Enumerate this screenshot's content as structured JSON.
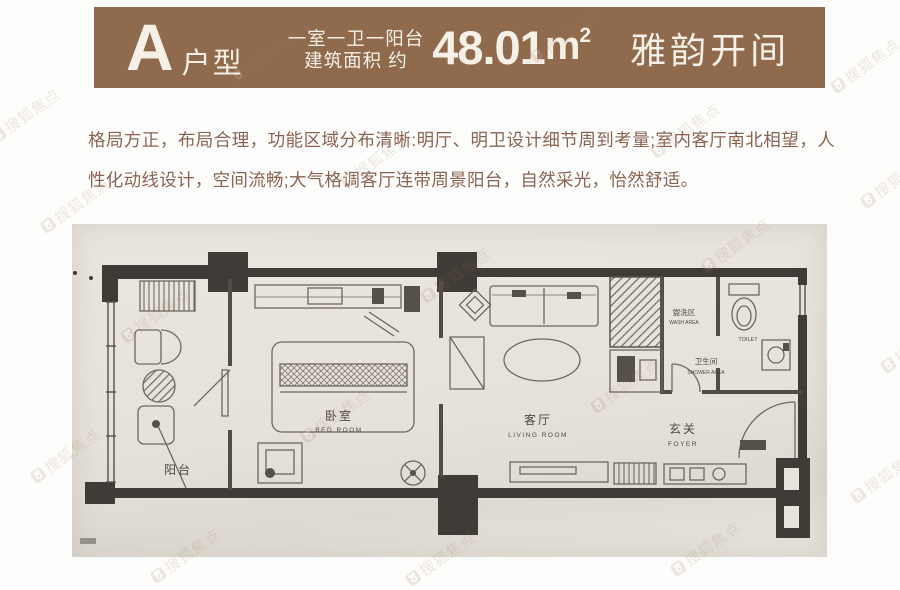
{
  "header": {
    "type_letter": "A",
    "type_label": "户型",
    "spec_line1": "一室一卫一阳台",
    "spec_line2": "建筑面积 约",
    "area_value": "48.01",
    "area_unit": "m",
    "area_exponent": "2",
    "name": "雅韵开间",
    "bg_color": "#8f6a4d",
    "text_color": "#f6f0e7"
  },
  "description": {
    "text": "格局方正，布局合理，功能区域分布清晰:明厅、明卫设计细节周到考量;室内客厅南北相望，人性化动线设计，空间流畅;大气格调客厅连带周景阳台，自然采光，怡然舒适。",
    "color": "#8a6352"
  },
  "floorplan": {
    "rooms": {
      "balcony": {
        "zh": "阳台"
      },
      "bedroom": {
        "zh": "卧室",
        "en": "BED ROOM"
      },
      "living": {
        "zh": "客厅",
        "en": "LIVING ROOM"
      },
      "foyer": {
        "zh": "玄关",
        "en": "FOYER"
      },
      "wash": {
        "zh": "盥洗区",
        "en": "WASH AREA"
      },
      "shower": {
        "zh": "卫生间",
        "en": "SHOWER AREA"
      },
      "toilet": {
        "en": "TOILET"
      }
    }
  },
  "watermark": {
    "text": "搜狐焦点",
    "color": "#a0765a",
    "positions": [
      [
        -15,
        105
      ],
      [
        225,
        45
      ],
      [
        525,
        25
      ],
      [
        825,
        55
      ],
      [
        35,
        195
      ],
      [
        335,
        150
      ],
      [
        645,
        120
      ],
      [
        855,
        170
      ],
      [
        115,
        305
      ],
      [
        415,
        265
      ],
      [
        695,
        235
      ],
      [
        875,
        335
      ],
      [
        25,
        445
      ],
      [
        295,
        405
      ],
      [
        585,
        375
      ],
      [
        845,
        465
      ],
      [
        145,
        545
      ],
      [
        400,
        548
      ],
      [
        665,
        538
      ]
    ]
  }
}
